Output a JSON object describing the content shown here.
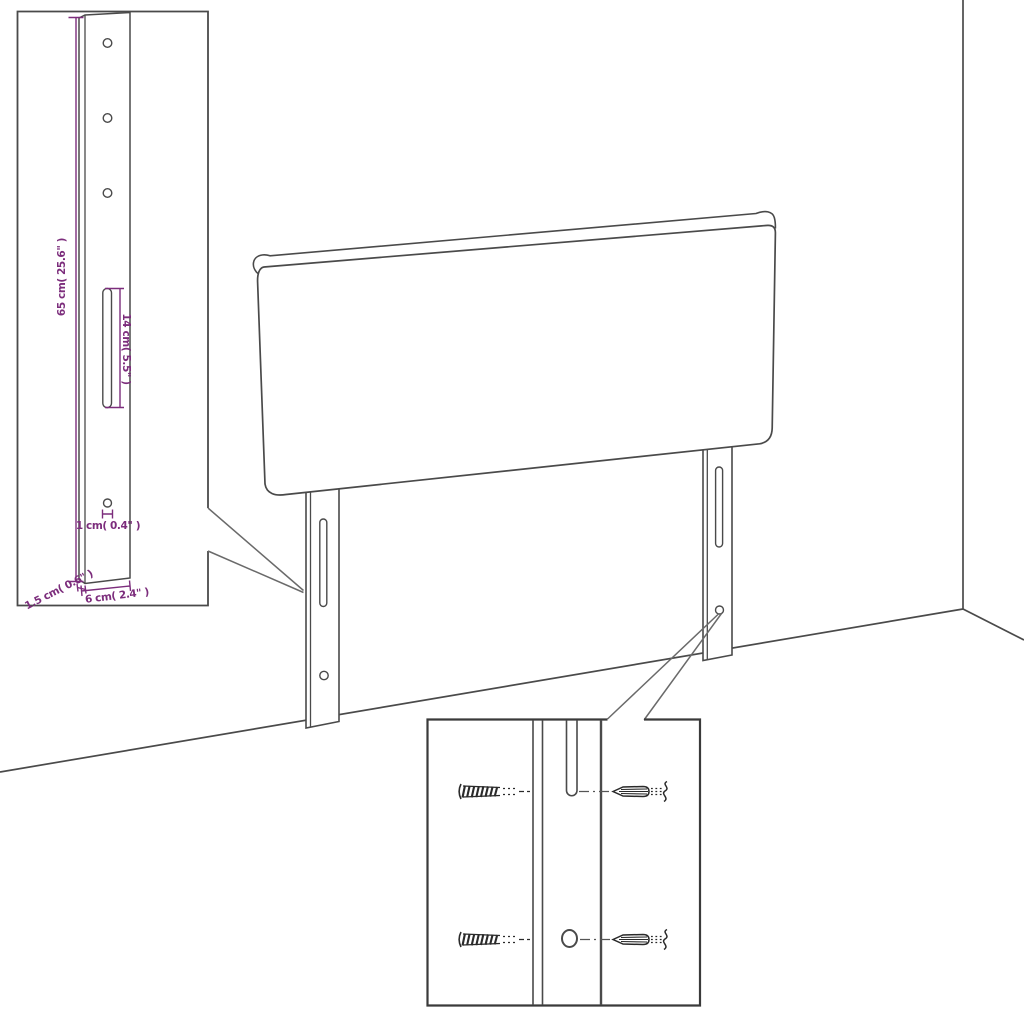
{
  "colors": {
    "dimension_accent": "#7c2d7c",
    "line": "#4a4a4a",
    "background": "#ffffff"
  },
  "labels": {
    "height": "65 cm( 25.6\" )",
    "slot": "14 cm( 5.5\" )",
    "hole": "1 cm( 0.4\" )",
    "depth": "1.5 cm( 0.6\" )",
    "width": "6 cm( 2.4\" )"
  }
}
